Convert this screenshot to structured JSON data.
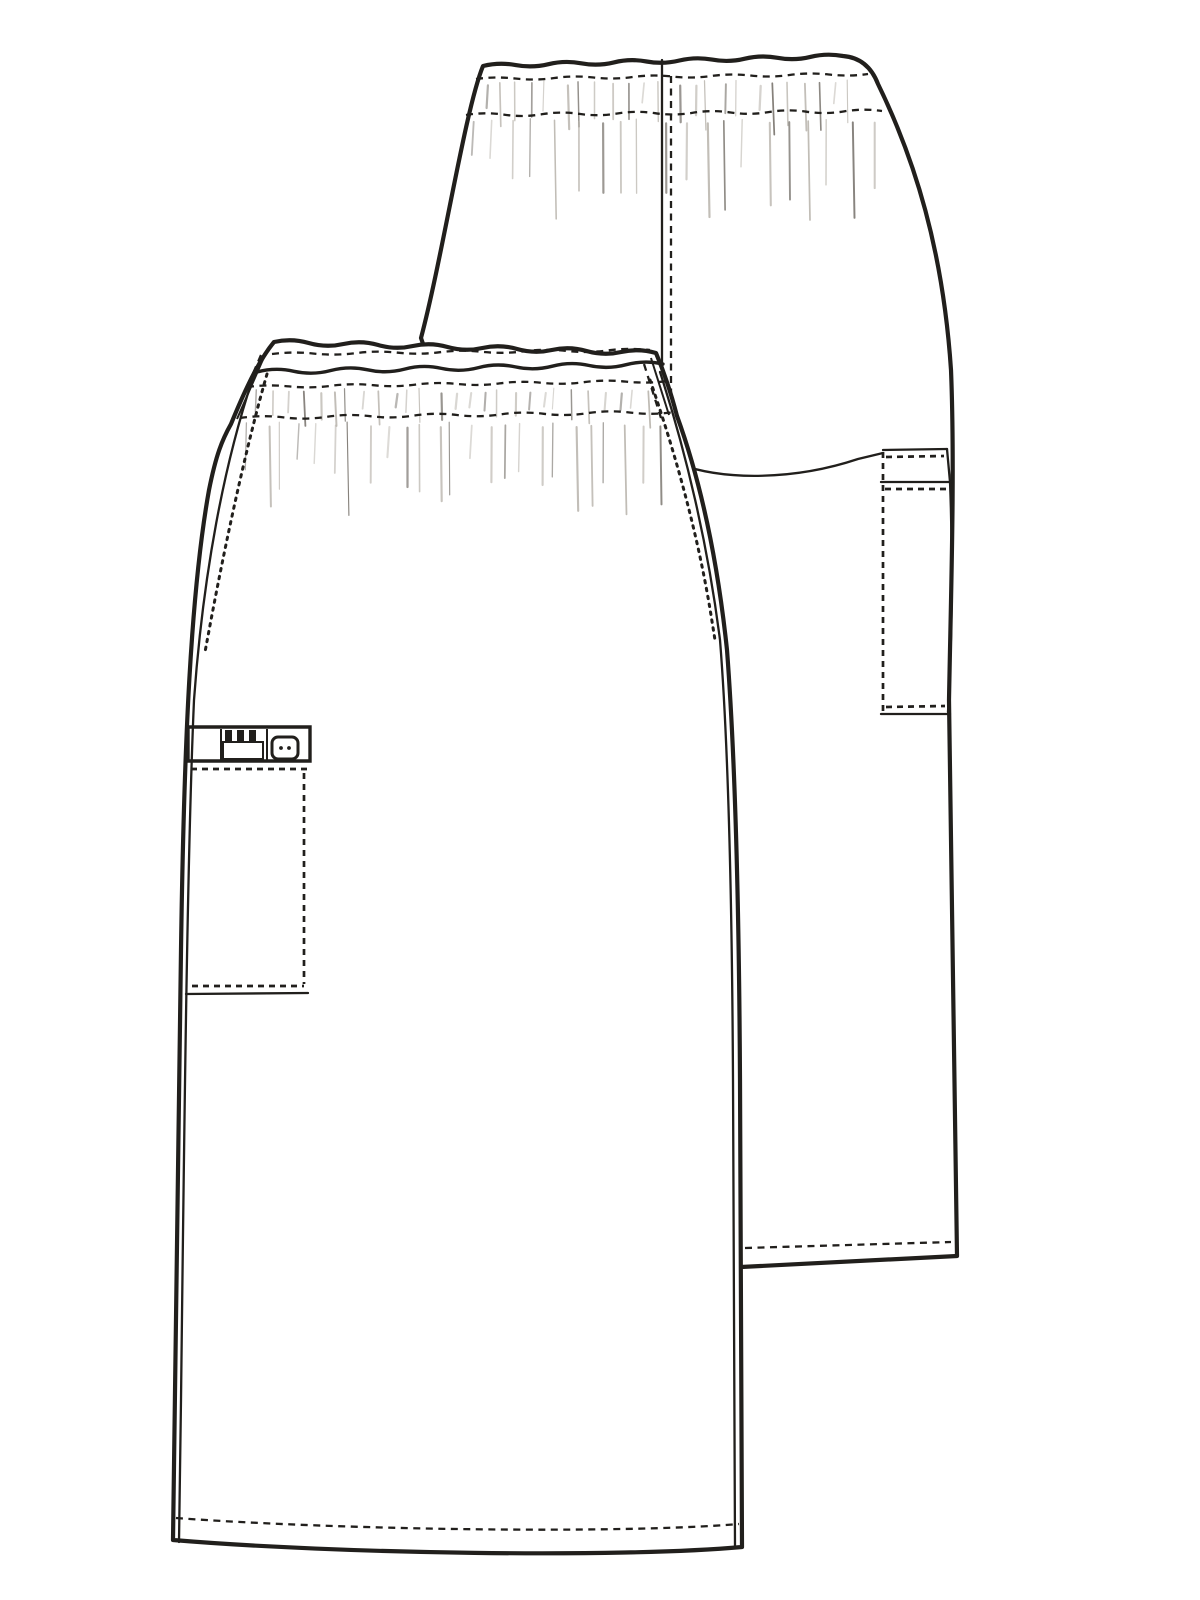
{
  "page": {
    "background": "#ffffff"
  },
  "sketch": {
    "label": "Technical flat sketch of an elastic-waist cargo skirt, back view behind and front view in front",
    "views": {
      "back": {
        "label": "Back view",
        "features": [
          "elastic waistband with gather shirring",
          "center back seam with topstitching",
          "side cargo pocket with stitched flap band",
          "topstitched hem"
        ]
      },
      "front": {
        "label": "Front view",
        "features": [
          "elastic waistband with double wavy edge and three stitch rows",
          "side seams with scalloped topstitching",
          "cargo pocket with button closure and instrument loop",
          "topstitched hem"
        ]
      }
    },
    "colors": {
      "line": "#211f1c",
      "shading_dark": "#6f6a63",
      "shading_light": "#b5b0a8",
      "paper": "#ffffff"
    }
  }
}
